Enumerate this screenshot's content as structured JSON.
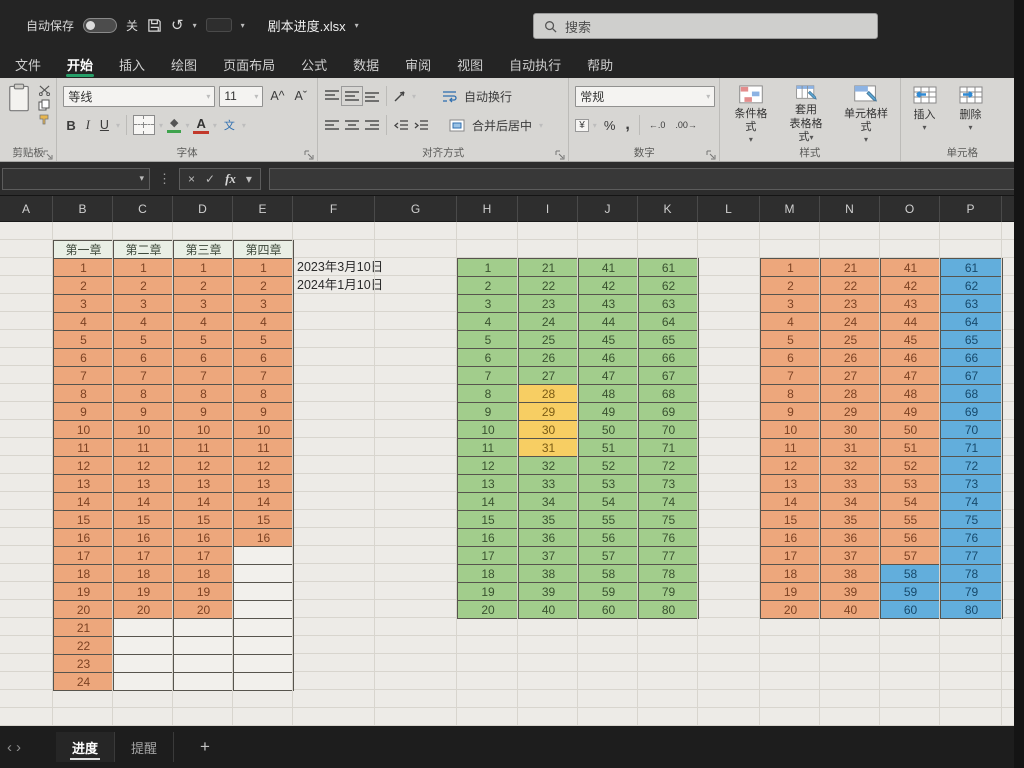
{
  "titlebar": {
    "autosave_label": "自动保存",
    "autosave_state": "关",
    "filename": "剧本进度.xlsx",
    "search_placeholder": "搜索"
  },
  "icons": {
    "undo": "↺",
    "caret": "▾",
    "dots": "⋮",
    "cancel": "×",
    "enter": "✓",
    "fx": "fx",
    "bold": "B",
    "italic": "I",
    "underline": "U",
    "font_grow": "A^",
    "font_shrink": "Aˇ",
    "pinyin": "文",
    "fill_diamond": "◆",
    "font_color_a": "A",
    "percent": "%",
    "comma": ",",
    "currency": "¥",
    "dec_left": "←.0",
    "dec_right": ".00→",
    "nav_prev": "‹",
    "nav_next": "›",
    "add": "+"
  },
  "ribbon": {
    "tabs": [
      {
        "label": "文件",
        "active": false
      },
      {
        "label": "开始",
        "active": true
      },
      {
        "label": "插入",
        "active": false
      },
      {
        "label": "绘图",
        "active": false
      },
      {
        "label": "页面布局",
        "active": false
      },
      {
        "label": "公式",
        "active": false
      },
      {
        "label": "数据",
        "active": false
      },
      {
        "label": "审阅",
        "active": false
      },
      {
        "label": "视图",
        "active": false
      },
      {
        "label": "自动执行",
        "active": false
      },
      {
        "label": "帮助",
        "active": false
      }
    ],
    "font": {
      "family_value": "等线",
      "size_value": "11"
    },
    "alignment": {
      "wrap_label": "自动换行",
      "merge_label": "合并后居中"
    },
    "number": {
      "format_value": "常规"
    },
    "styles": {
      "conditional_label": "条件格式",
      "format_table_line1": "套用",
      "format_table_line2": "表格格式",
      "cell_styles_label": "单元格样式"
    },
    "cells": {
      "insert_label": "插入",
      "delete_label": "删除"
    },
    "group_labels": {
      "clipboard": "剪贴板",
      "font": "字体",
      "alignment": "对齐方式",
      "number": "数字",
      "styles": "样式",
      "cells": "单元格"
    }
  },
  "formula_bar": {
    "name_box_value": "",
    "formula_value": ""
  },
  "sheet": {
    "column_headers": [
      "A",
      "B",
      "C",
      "D",
      "E",
      "F",
      "G",
      "H",
      "I",
      "J",
      "K",
      "L",
      "M",
      "N",
      "O",
      "P"
    ],
    "notes": [
      "2023年3月10日",
      "2024年1月10日"
    ],
    "cell_palette": {
      "orange": {
        "bg": "#EDA77C",
        "text": "#7C4223"
      },
      "green": {
        "bg": "#A2CD8C",
        "text": "#39512F"
      },
      "yellow": {
        "bg": "#F7CE63",
        "text": "#7A5A14"
      },
      "blue": {
        "bg": "#62AEDC",
        "text": "#17496B"
      },
      "tableHeader": {
        "bg": "#E9EFE5",
        "text": "#3F4A3C"
      },
      "empty": {
        "bg": "#F2F0EC",
        "text": "#999999"
      }
    },
    "tables": {
      "left": {
        "headers": [
          "第一章",
          "第二章",
          "第三章",
          "第四章"
        ],
        "header_fill": "tableHeader",
        "fill": "orange",
        "row_count": 24,
        "columns": [
          {
            "values": [
              1,
              2,
              3,
              4,
              5,
              6,
              7,
              8,
              9,
              10,
              11,
              12,
              13,
              14,
              15,
              16,
              17,
              18,
              19,
              20,
              21,
              22,
              23,
              24
            ]
          },
          {
            "values": [
              1,
              2,
              3,
              4,
              5,
              6,
              7,
              8,
              9,
              10,
              11,
              12,
              13,
              14,
              15,
              16,
              17,
              18,
              19,
              20
            ]
          },
          {
            "values": [
              1,
              2,
              3,
              4,
              5,
              6,
              7,
              8,
              9,
              10,
              11,
              12,
              13,
              14,
              15,
              16,
              17,
              18,
              19,
              20
            ]
          },
          {
            "values": [
              1,
              2,
              3,
              4,
              5,
              6,
              7,
              8,
              9,
              10,
              11,
              12,
              13,
              14,
              15,
              16
            ]
          }
        ],
        "overrides": []
      },
      "middle": {
        "fill": "green",
        "row_count": 20,
        "columns": [
          {
            "values": [
              1,
              2,
              3,
              4,
              5,
              6,
              7,
              8,
              9,
              10,
              11,
              12,
              13,
              14,
              15,
              16,
              17,
              18,
              19,
              20
            ]
          },
          {
            "values": [
              21,
              22,
              23,
              24,
              25,
              26,
              27,
              28,
              29,
              30,
              31,
              32,
              33,
              34,
              35,
              36,
              37,
              38,
              39,
              40
            ]
          },
          {
            "values": [
              41,
              42,
              43,
              44,
              45,
              46,
              47,
              48,
              49,
              50,
              51,
              52,
              53,
              54,
              55,
              56,
              57,
              58,
              59,
              60
            ]
          },
          {
            "values": [
              61,
              62,
              63,
              64,
              65,
              66,
              67,
              68,
              69,
              70,
              71,
              72,
              73,
              74,
              75,
              76,
              77,
              78,
              79,
              80
            ]
          }
        ],
        "overrides": [
          {
            "col": 1,
            "row_start": 7,
            "row_end": 10,
            "fill": "yellow"
          }
        ]
      },
      "right": {
        "fill": "orange",
        "row_count": 20,
        "columns": [
          {
            "values": [
              1,
              2,
              3,
              4,
              5,
              6,
              7,
              8,
              9,
              10,
              11,
              12,
              13,
              14,
              15,
              16,
              17,
              18,
              19,
              20
            ]
          },
          {
            "values": [
              21,
              22,
              23,
              24,
              25,
              26,
              27,
              28,
              29,
              30,
              31,
              32,
              33,
              34,
              35,
              36,
              37,
              38,
              39,
              40
            ]
          },
          {
            "values": [
              41,
              42,
              43,
              44,
              45,
              46,
              47,
              48,
              49,
              50,
              51,
              52,
              53,
              54,
              55,
              56,
              57,
              58,
              59,
              60
            ]
          },
          {
            "values": [
              61,
              62,
              63,
              64,
              65,
              66,
              67,
              68,
              69,
              70,
              71,
              72,
              73,
              74,
              75,
              76,
              77,
              78,
              79,
              80
            ]
          }
        ],
        "overrides": [
          {
            "col": 2,
            "row_start": 17,
            "row_end": 19,
            "fill": "blue"
          },
          {
            "col": 3,
            "row_start": 0,
            "row_end": 19,
            "fill": "blue"
          }
        ]
      }
    }
  },
  "sheet_tabs": {
    "tabs": [
      {
        "label": "进度",
        "active": true
      },
      {
        "label": "提醒",
        "active": false
      }
    ]
  }
}
